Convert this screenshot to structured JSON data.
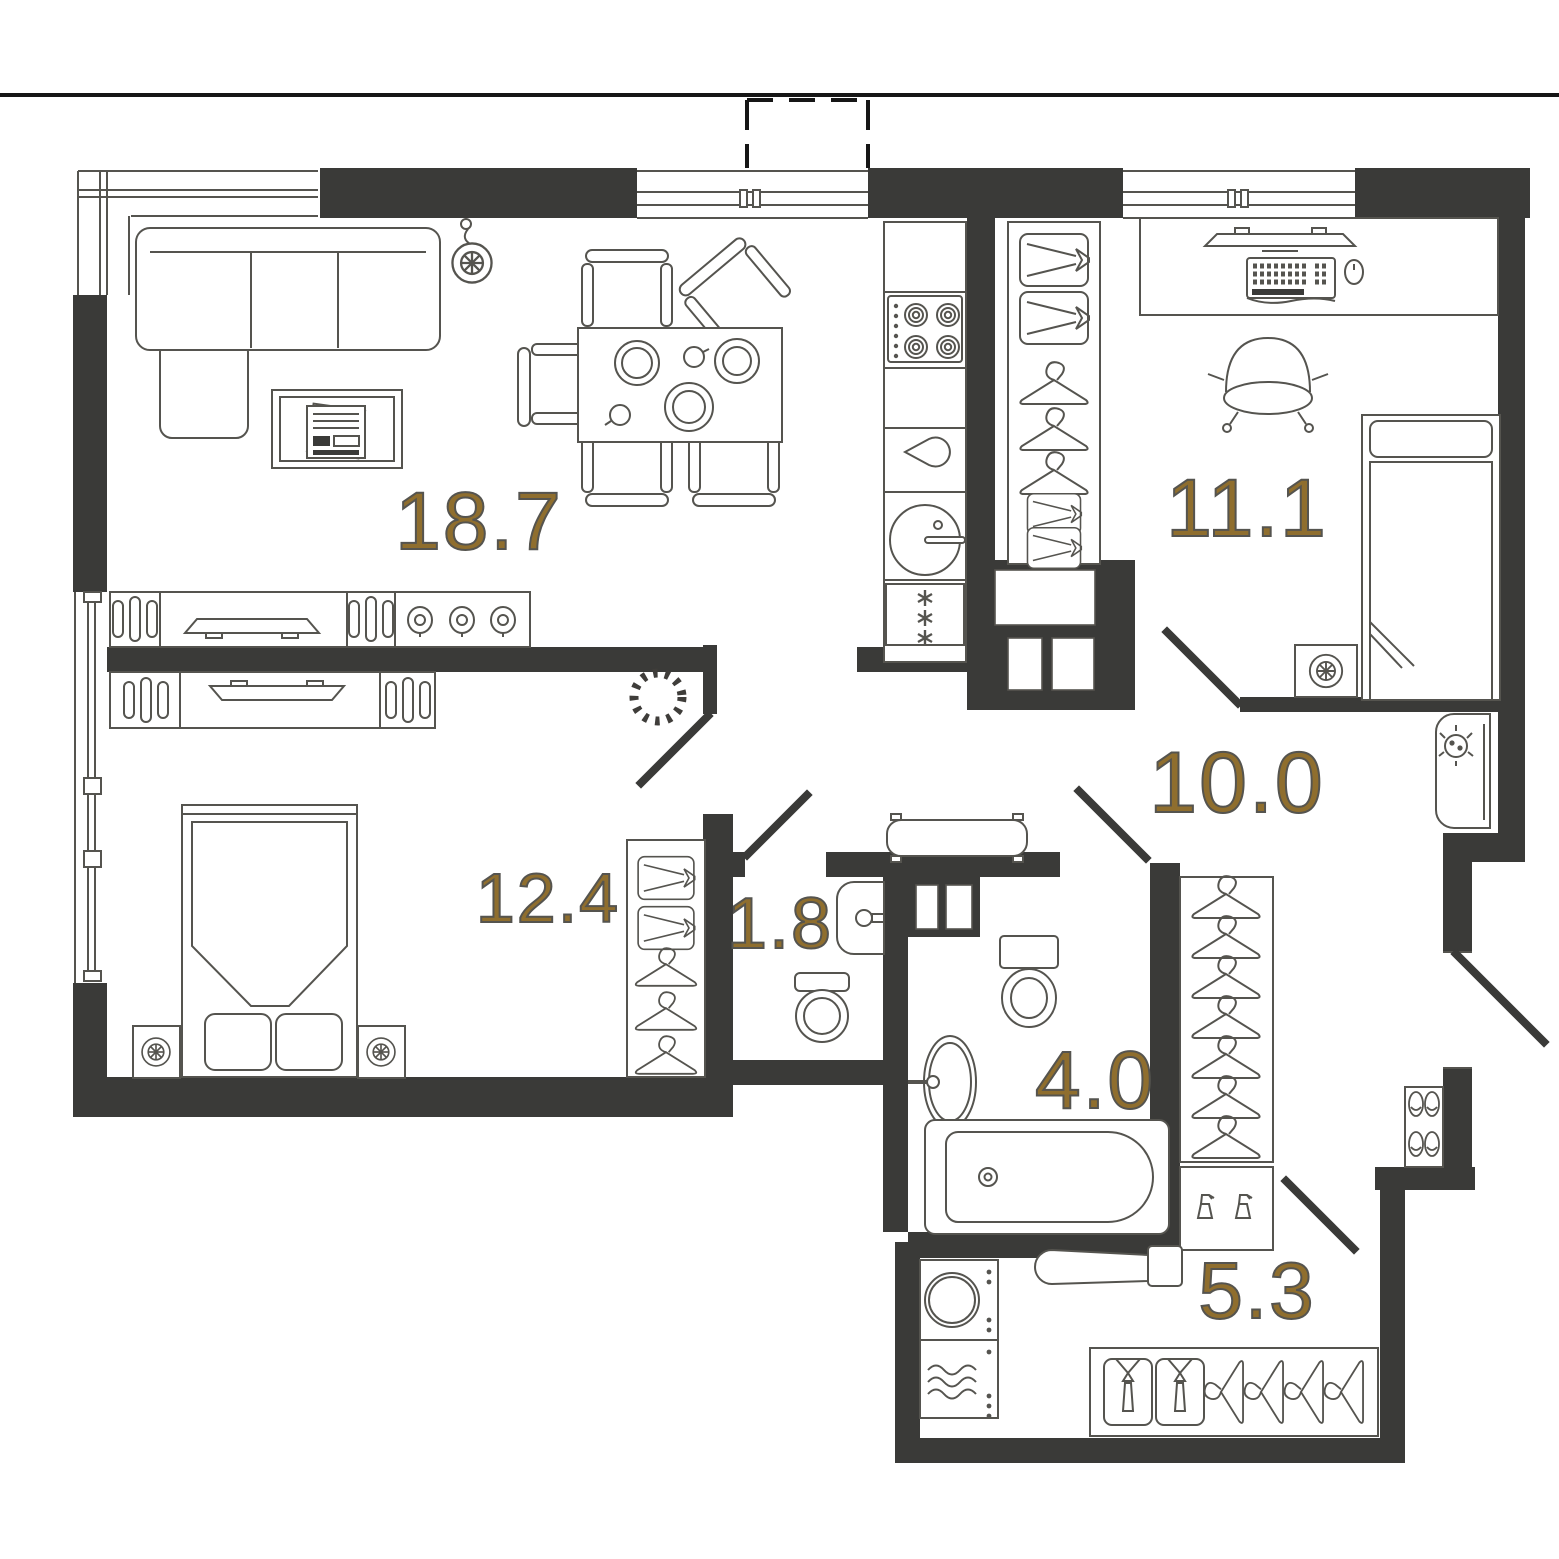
{
  "colors": {
    "wall": "#3a3a38",
    "furniture_line": "#55544f",
    "area_label": "#8f6e2e",
    "background": "#ffffff"
  },
  "plan": {
    "type": "apartment-floor-plan",
    "rooms": [
      {
        "id": "living-kitchen",
        "area": "18.7",
        "furniture": [
          "corner-sofa",
          "pendant-lamp",
          "coffee-table",
          "dining-table",
          "chairs",
          "tv-console",
          "stove",
          "kettle",
          "kitchen-sink",
          "fridge"
        ]
      },
      {
        "id": "bedroom-2",
        "area": "11.1",
        "furniture": [
          "wardrobe",
          "desk",
          "monitor",
          "keyboard",
          "mouse",
          "office-chair",
          "single-bed",
          "nightstand-lamp"
        ]
      },
      {
        "id": "bedroom-1",
        "area": "12.4",
        "furniture": [
          "double-bed",
          "nightstands",
          "tv-console",
          "wardrobe",
          "wreath-decor"
        ]
      },
      {
        "id": "wc",
        "area": "1.8",
        "furniture": [
          "wash-basin",
          "toilet"
        ]
      },
      {
        "id": "hallway",
        "area": "10.0",
        "furniture": [
          "towel-radiator",
          "console-table",
          "open-wardrobe",
          "cleaning-shelf",
          "shoe-rack"
        ]
      },
      {
        "id": "bathroom",
        "area": "4.0",
        "furniture": [
          "toilet",
          "vanity-mirror",
          "bathtub"
        ]
      },
      {
        "id": "laundry",
        "area": "5.3",
        "furniture": [
          "washing-machine",
          "dryer",
          "ironing-board",
          "garment-rack"
        ]
      }
    ]
  }
}
